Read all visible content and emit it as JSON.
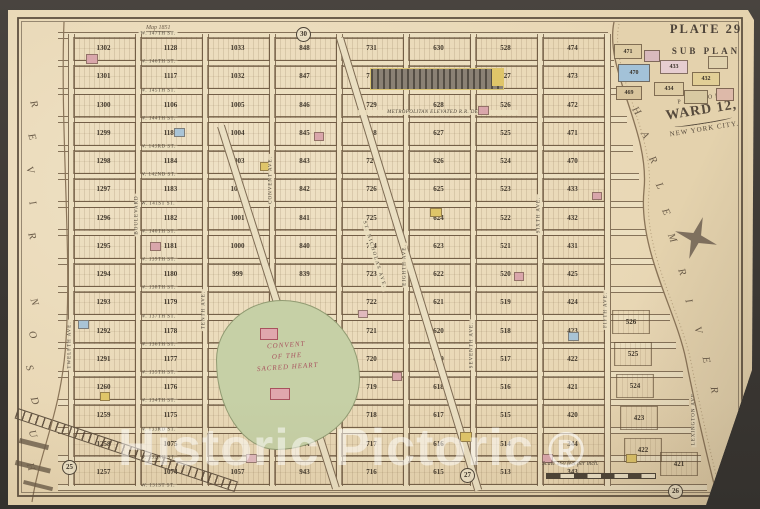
{
  "title": {
    "plate": "PLATE 29",
    "sub_plan": "SUB PLAN"
  },
  "cartouche": {
    "line1": "PART OF",
    "line2": "WARD 12,",
    "line3": "NEW YORK CITY."
  },
  "rivers": {
    "hudson": "HUDSON RIVER",
    "harlem_word1": "HARLEM",
    "harlem_word2": "RIVER"
  },
  "note_1851": "Map 1851",
  "scale": {
    "text": "Scale 160 feet per inch."
  },
  "watermark": {
    "text": "Historic Pictoric",
    "registered": "®"
  },
  "plate_refs": [
    {
      "label": "30",
      "x": 288,
      "y": 17
    },
    {
      "label": "25",
      "x": 54,
      "y": 450
    },
    {
      "label": "27",
      "x": 452,
      "y": 458
    },
    {
      "label": "26",
      "x": 660,
      "y": 474
    }
  ],
  "streets": [
    "W. 147TH ST.",
    "W. 146TH ST.",
    "W. 145TH ST.",
    "W. 144TH ST.",
    "W. 143RD ST.",
    "W. 142ND ST.",
    "W. 141ST ST.",
    "W. 140TH ST.",
    "W. 139TH ST.",
    "W. 138TH ST.",
    "W. 137TH ST.",
    "W. 136TH ST.",
    "W. 135TH ST.",
    "W. 134TH ST.",
    "W. 133RD ST.",
    "W. 132ND ST.",
    "W. 131ST ST."
  ],
  "avenues": [
    {
      "name": "TWELFTH AVE.",
      "x": 62,
      "y": 335
    },
    {
      "name": "BOULEVARD",
      "x": 129,
      "y": 205
    },
    {
      "name": "TENTH AVE.",
      "x": 196,
      "y": 300
    },
    {
      "name": "CONVENT AVE.",
      "x": 263,
      "y": 170
    },
    {
      "name": "EIGHTH AVE.",
      "x": 397,
      "y": 255
    },
    {
      "name": "SEVENTH AVE.",
      "x": 464,
      "y": 335
    },
    {
      "name": "SIXTH AVE.",
      "x": 531,
      "y": 205
    },
    {
      "name": "FIFTH AVE.",
      "x": 598,
      "y": 300
    },
    {
      "name": "LEXINGTON AVE.",
      "x": 686,
      "y": 408
    }
  ],
  "st_nicholas": "ST. NICHOLAS AVE.",
  "layout": {
    "grid_x": [
      62,
      129,
      196,
      263,
      330,
      397,
      464,
      531,
      598
    ],
    "row0": 24,
    "row_h": 28.25
  },
  "blocks": {
    "columns": [
      [
        "1302",
        "1301",
        "1300",
        "1299",
        "1298",
        "1297",
        "1296",
        "1295",
        "1294",
        "1293",
        "1292",
        "1291",
        "1260",
        "1259",
        "1258",
        "1257"
      ],
      [
        "1128",
        "1117",
        "1106",
        "1185",
        "1184",
        "1183",
        "1182",
        "1181",
        "1180",
        "1179",
        "1178",
        "1177",
        "1176",
        "1175",
        "1075",
        "1074"
      ],
      [
        "1033",
        "1032",
        "1005",
        "1004",
        "1003",
        "1002",
        "1001",
        "1000",
        "999",
        "",
        "",
        "",
        "",
        "",
        "",
        "1057"
      ],
      [
        "848",
        "847",
        "846",
        "845",
        "843",
        "842",
        "841",
        "840",
        "839",
        "",
        "",
        "",
        "",
        "",
        "944",
        "943"
      ],
      [
        "731",
        "730",
        "729",
        "728",
        "727",
        "726",
        "725",
        "724",
        "723",
        "722",
        "721",
        "720",
        "719",
        "718",
        "717",
        "716"
      ],
      [
        "630",
        "629",
        "628",
        "627",
        "626",
        "625",
        "624",
        "623",
        "622",
        "621",
        "620",
        "619",
        "618",
        "617",
        "616",
        "615"
      ],
      [
        "528",
        "527",
        "526",
        "525",
        "524",
        "523",
        "522",
        "521",
        "520",
        "519",
        "518",
        "517",
        "516",
        "515",
        "514",
        "513"
      ],
      [
        "474",
        "473",
        "472",
        "471",
        "470",
        "433",
        "432",
        "431",
        "425",
        "424",
        "423",
        "422",
        "421",
        "420",
        "344",
        "343"
      ]
    ]
  },
  "landmarks": {
    "depot_label": "METROPOLITAN ELEVATED R.R. DEPOT",
    "convent": {
      "line1": "CONVENT",
      "line2": "OF THE",
      "line3": "SACRED HEART"
    }
  },
  "east_cells": [
    {
      "label": "526",
      "x": 604,
      "y": 300
    },
    {
      "label": "525",
      "x": 606,
      "y": 332
    },
    {
      "label": "524",
      "x": 608,
      "y": 364
    },
    {
      "label": "423",
      "x": 612,
      "y": 396
    },
    {
      "label": "422",
      "x": 616,
      "y": 428
    },
    {
      "label": "421",
      "x": 652,
      "y": 442
    }
  ],
  "inset_blocks": [
    {
      "label": "471",
      "x": 606,
      "y": 34,
      "w": 26,
      "h": 13,
      "color": "#decca4"
    },
    {
      "label": "470",
      "x": 610,
      "y": 54,
      "w": 30,
      "h": 16,
      "color": "#a3c2d8"
    },
    {
      "label": "433",
      "x": 652,
      "y": 50,
      "w": 26,
      "h": 12,
      "color": "#e6cdd0"
    },
    {
      "label": "432",
      "x": 684,
      "y": 62,
      "w": 26,
      "h": 12,
      "color": "#e2cf96"
    },
    {
      "label": "434",
      "x": 646,
      "y": 72,
      "w": 28,
      "h": 12,
      "color": "#decca4"
    },
    {
      "label": "469",
      "x": 608,
      "y": 76,
      "w": 24,
      "h": 12,
      "color": "#d8c49c"
    },
    {
      "label": "",
      "x": 636,
      "y": 40,
      "w": 14,
      "h": 10,
      "color": "#d8b9bd"
    },
    {
      "label": "",
      "x": 700,
      "y": 46,
      "w": 18,
      "h": 11,
      "color": "#e0d2ae"
    },
    {
      "label": "",
      "x": 676,
      "y": 80,
      "w": 22,
      "h": 12,
      "color": "#d8c9a2"
    },
    {
      "label": "",
      "x": 708,
      "y": 78,
      "w": 16,
      "h": 11,
      "color": "#ddb9a9"
    }
  ],
  "accents": [
    {
      "x": 78,
      "y": 44,
      "w": 10,
      "h": 8,
      "c": "#d9a6ab"
    },
    {
      "x": 166,
      "y": 118,
      "w": 9,
      "h": 7,
      "c": "#a9c4d6"
    },
    {
      "x": 252,
      "y": 152,
      "w": 9,
      "h": 7,
      "c": "#dfc569"
    },
    {
      "x": 306,
      "y": 122,
      "w": 8,
      "h": 7,
      "c": "#d9a6ab"
    },
    {
      "x": 142,
      "y": 232,
      "w": 9,
      "h": 7,
      "c": "#d9a6ab"
    },
    {
      "x": 422,
      "y": 198,
      "w": 10,
      "h": 7,
      "c": "#dfc569"
    },
    {
      "x": 506,
      "y": 262,
      "w": 8,
      "h": 7,
      "c": "#d9a6ab"
    },
    {
      "x": 560,
      "y": 322,
      "w": 9,
      "h": 7,
      "c": "#a9c4d6"
    },
    {
      "x": 384,
      "y": 362,
      "w": 8,
      "h": 7,
      "c": "#d9a6ab"
    },
    {
      "x": 452,
      "y": 422,
      "w": 10,
      "h": 8,
      "c": "#dfc569"
    },
    {
      "x": 534,
      "y": 444,
      "w": 9,
      "h": 7,
      "c": "#d9a6ab"
    },
    {
      "x": 92,
      "y": 382,
      "w": 8,
      "h": 7,
      "c": "#dfc569"
    },
    {
      "x": 350,
      "y": 300,
      "w": 8,
      "h": 6,
      "c": "#e0b9bd"
    },
    {
      "x": 584,
      "y": 182,
      "w": 8,
      "h": 6,
      "c": "#d9a6ab"
    },
    {
      "x": 238,
      "y": 444,
      "w": 9,
      "h": 7,
      "c": "#e0b9bd"
    },
    {
      "x": 618,
      "y": 444,
      "w": 9,
      "h": 7,
      "c": "#dfc569"
    },
    {
      "x": 70,
      "y": 310,
      "w": 9,
      "h": 7,
      "c": "#a9c4d6"
    },
    {
      "x": 470,
      "y": 96,
      "w": 9,
      "h": 7,
      "c": "#d9a6ab"
    }
  ],
  "colors": {
    "paper": "#e9d8b6",
    "river": "#e4d2ad",
    "park": "#c6d0a6",
    "ink": "#4b4236",
    "depot_yellow": "#dfc569"
  }
}
